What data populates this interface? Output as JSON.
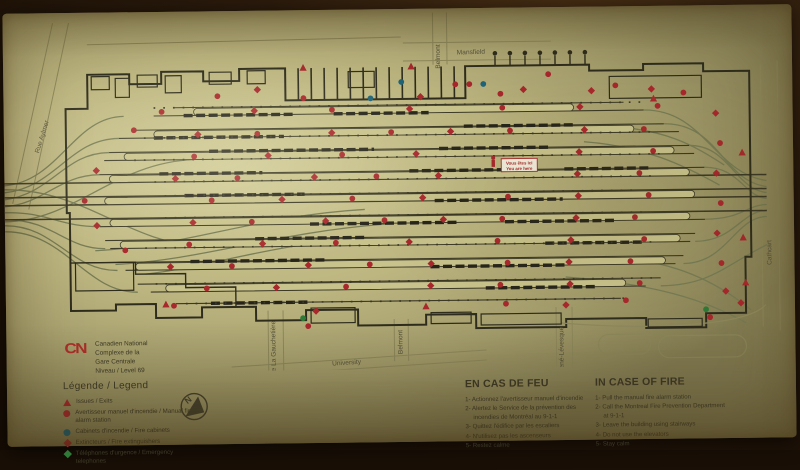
{
  "sign": {
    "brand": {
      "logo": "CN",
      "name": "Canadien National",
      "complex_line1": "Complexe de la",
      "complex_line2": "Gare Centrale",
      "level": "Niveau / Level  69"
    },
    "legend": {
      "title": "Légende / Legend",
      "items": [
        {
          "icon": "exit-arrow",
          "color": "#a8282c",
          "label": "Issues / Exits"
        },
        {
          "icon": "circle",
          "color": "#a8282c",
          "label": "Avertisseur manuel d'incendie / Manual fire alarm station"
        },
        {
          "icon": "circle",
          "color": "#1f6478",
          "label": "Cabinets d'incendie / Fire cabinets"
        },
        {
          "icon": "diamond",
          "color": "#a8282c",
          "label": "Extincteurs / Fire extinguishers"
        },
        {
          "icon": "diamond",
          "color": "#2e7a36",
          "label": "Téléphones d'urgence / Emergency telephones"
        }
      ]
    },
    "compass": {
      "label": "N"
    },
    "map": {
      "you_are_here_fr": "Vous êtes ici",
      "you_are_here_en": "You are here",
      "streets": {
        "belmont_top": "Belmont",
        "mansfield": "Mansfield",
        "rue_left": "Rue Aylmer",
        "de_la_gauchetiere": "De La Gauchetière",
        "university": "University",
        "belmont_bottom": "Belmont",
        "rene_levesque": "René-Lévesque",
        "cathcart": "Cathcart"
      }
    },
    "fire_fr": {
      "title": "EN CAS DE FEU",
      "steps": [
        "1- Actionnez l'avertisseur manuel d'incendie",
        "2- Alertez le Service de la prévention des incendies de Montréal au 9-1-1",
        "3- Quittez l'édifice par les escaliers",
        "4- N'utilisez pas les ascenseurs",
        "5- Restez calme"
      ]
    },
    "fire_en": {
      "title": "IN CASE OF FIRE",
      "steps": [
        "1- Pull the manual fire alarm station",
        "2- Call the Montreal Fire Prevention Department at 9-1-1",
        "3- Leave the building using stairways",
        "4- Do not use the elevators",
        "5- Stay calm"
      ]
    },
    "colors": {
      "red": "#a8282c",
      "teal": "#1f6478",
      "green": "#2e7a36",
      "sign_background": "#b6b07a",
      "line_dark": "#3a3826",
      "track_olive": "#767b54"
    }
  }
}
